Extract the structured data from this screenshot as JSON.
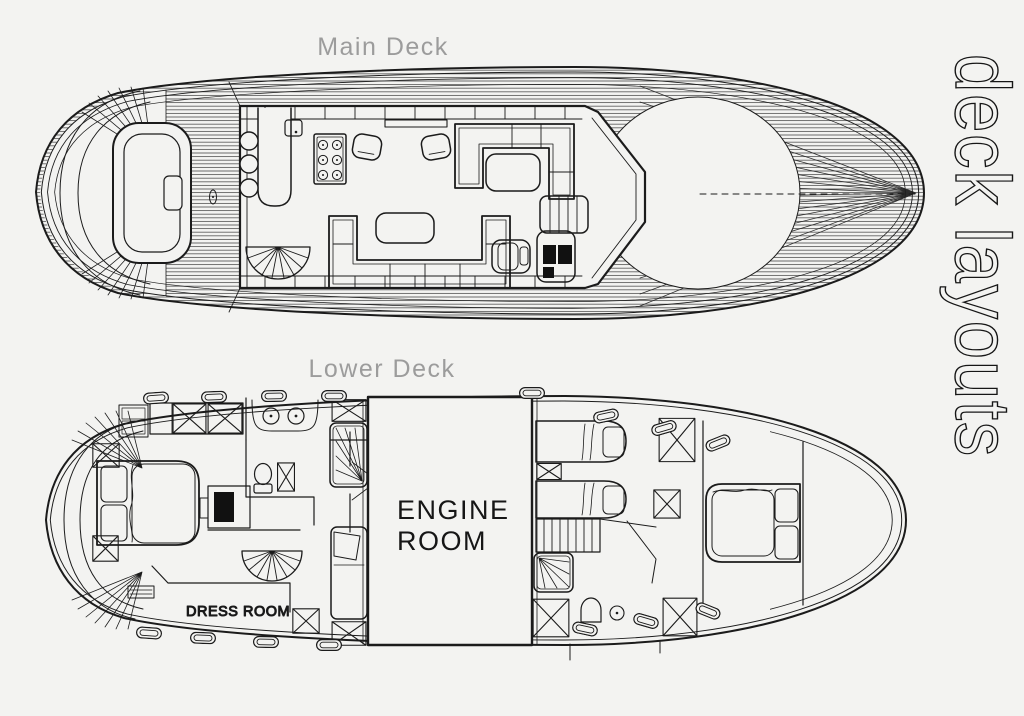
{
  "document": {
    "background_color": "#f3f3f1",
    "line_color": "#1b1b1b",
    "title_color": "#9c9c9c"
  },
  "side_label": "deck layouts",
  "main_deck": {
    "title": "Main Deck"
  },
  "lower_deck": {
    "title": "Lower Deck",
    "engine_room_label_line1": "ENGINE",
    "engine_room_label_line2": "ROOM",
    "dress_room_label": "DRESS ROOM"
  }
}
